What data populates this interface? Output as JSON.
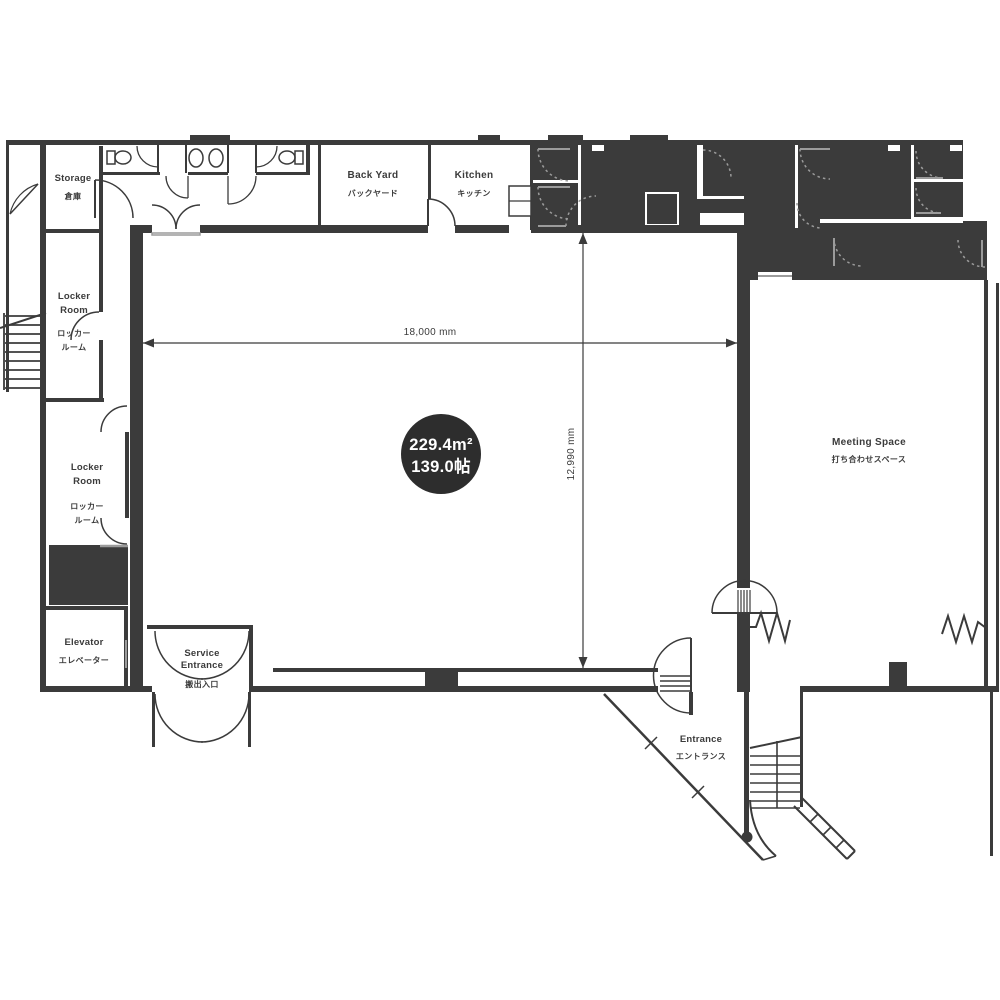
{
  "colors": {
    "ink": "#3b3b3b",
    "badge_fill": "#2d2d2d",
    "door_gray": "#9b9b9b",
    "background": "#ffffff"
  },
  "area_badge": {
    "area_m2": "229.4m²",
    "area_jo": "139.0帖"
  },
  "dimensions": {
    "width_label": "18,000 mm",
    "height_label": "12,990 mm"
  },
  "rooms": {
    "storage": {
      "en": "Storage",
      "ja": "倉庫"
    },
    "locker_room_upper": {
      "en1": "Locker",
      "en2": "Room",
      "ja1": "ロッカー",
      "ja2": "ルーム"
    },
    "locker_room_lower": {
      "en1": "Locker",
      "en2": "Room",
      "ja1": "ロッカー",
      "ja2": "ルーム"
    },
    "back_yard": {
      "en": "Back Yard",
      "ja": "バックヤード"
    },
    "kitchen": {
      "en": "Kitchen",
      "ja": "キッチン"
    },
    "meeting_space": {
      "en": "Meeting Space",
      "ja": "打ち合わせスペース"
    },
    "elevator": {
      "en": "Elevator",
      "ja": "エレベーター"
    },
    "service_entrance": {
      "en1": "Service",
      "en2": "Entrance",
      "ja": "搬出入口"
    },
    "entrance": {
      "en": "Entrance",
      "ja": "エントランス"
    }
  }
}
